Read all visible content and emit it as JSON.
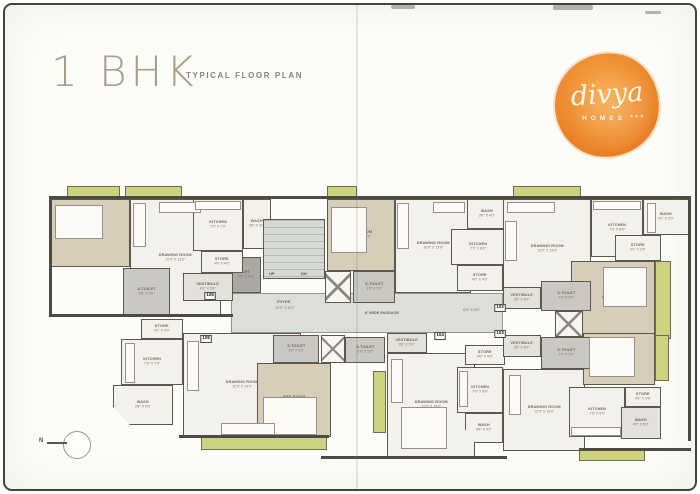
{
  "header": {
    "title": "1 BHK",
    "subtitle": "TYPICAL FLOOR PLAN"
  },
  "logo": {
    "name": "divya",
    "sub": "HOMES",
    "stars": "✶✶✶"
  },
  "compass": {
    "label": "N"
  },
  "colors": {
    "balcony_green": "#ccd27e",
    "bedroom_beige": "#d8cdb9",
    "toilet_gray": "#c9c8c2",
    "room_white": "#f3f1eb",
    "corridor_gray": "#dcded8",
    "lift_gray": "#a9a8a2",
    "wall_dark": "#4c4a42",
    "logo_orange": "#ef8f33",
    "title_taupe": "#a89e8a"
  },
  "plan": {
    "rooms": [
      {
        "f": "balc",
        "x": 62,
        "y": 181,
        "w": 53,
        "h": 13
      },
      {
        "f": "balc",
        "x": 120,
        "y": 181,
        "w": 57,
        "h": 13
      },
      {
        "f": "balc",
        "x": 322,
        "y": 181,
        "w": 30,
        "h": 13
      },
      {
        "f": "balc",
        "x": 508,
        "y": 181,
        "w": 68,
        "h": 11
      },
      {
        "f": "balc",
        "x": 650,
        "y": 256,
        "w": 16,
        "h": 78
      },
      {
        "f": "balc",
        "x": 196,
        "y": 432,
        "w": 126,
        "h": 13
      },
      {
        "f": "balc",
        "x": 368,
        "y": 366,
        "w": 13,
        "h": 62
      },
      {
        "f": "balc",
        "x": 650,
        "y": 330,
        "w": 14,
        "h": 46
      },
      {
        "f": "balc",
        "x": 574,
        "y": 444,
        "w": 66,
        "h": 12
      },
      {
        "n": "BED ROOM",
        "d": "10'0\" X 12'0\"",
        "f": "bed",
        "x": 45,
        "y": 194,
        "w": 80,
        "h": 68
      },
      {
        "n": "DRAWING ROOM",
        "d": "10'0\" X 13'0\"",
        "f": "wht",
        "x": 125,
        "y": 194,
        "w": 91,
        "h": 117
      },
      {
        "n": "KITCHEN",
        "d": "7'0\" X 7'0\"",
        "f": "wht",
        "x": 188,
        "y": 194,
        "w": 50,
        "h": 52
      },
      {
        "n": "WASH",
        "d": "3'6\" X 4'0\"",
        "f": "wht",
        "x": 238,
        "y": 194,
        "w": 28,
        "h": 50
      },
      {
        "n": "BED ROOM",
        "d": "10'0\" X 12'0\"",
        "f": "bed",
        "x": 322,
        "y": 194,
        "w": 68,
        "h": 72
      },
      {
        "n": "DRAWING ROOM",
        "d": "10'0\" X 13'0\"",
        "f": "wht",
        "x": 390,
        "y": 194,
        "w": 76,
        "h": 94
      },
      {
        "n": "WASH",
        "d": "3'6\" X 4'0\"",
        "f": "wht",
        "x": 462,
        "y": 194,
        "w": 40,
        "h": 30
      },
      {
        "n": "KITCHEN",
        "d": "7'0\" X 8'0\"",
        "f": "wht",
        "x": 446,
        "y": 224,
        "w": 54,
        "h": 36
      },
      {
        "n": "STORE",
        "d": "4'0\" X 4'0\"",
        "f": "wht",
        "x": 452,
        "y": 260,
        "w": 46,
        "h": 26
      },
      {
        "n": "DRAWING ROOM",
        "d": "11'0\" X 13'0\"",
        "f": "wht",
        "x": 498,
        "y": 194,
        "w": 88,
        "h": 100
      },
      {
        "n": "KITCHEN",
        "d": "7'0\" X 8'0\"",
        "f": "wht",
        "x": 586,
        "y": 194,
        "w": 52,
        "h": 58
      },
      {
        "n": "WASH",
        "d": "4'0\" X 5'0\"",
        "f": "wht",
        "x": 638,
        "y": 194,
        "w": 46,
        "h": 36
      },
      {
        "n": "STORE",
        "d": "4'0\" X 3'6\"",
        "f": "wht",
        "x": 610,
        "y": 230,
        "w": 46,
        "h": 26
      },
      {
        "n": "BED ROOM",
        "d": "11'0\" X 10'0\"",
        "f": "bed",
        "x": 566,
        "y": 256,
        "w": 84,
        "h": 78
      },
      {
        "n": "DRAWING ROOM",
        "d": "10'0\" X 14'0\"",
        "f": "wht",
        "x": 178,
        "y": 328,
        "w": 118,
        "h": 104
      },
      {
        "n": "STORE",
        "d": "4'0\" X 4'0\"",
        "f": "wht",
        "x": 136,
        "y": 314,
        "w": 42,
        "h": 20
      },
      {
        "n": "KITCHEN",
        "d": "7'0\" X 7'0\"",
        "f": "wht",
        "x": 116,
        "y": 334,
        "w": 62,
        "h": 46
      },
      {
        "n": "WASH",
        "d": "3'6\" X 5'0\"",
        "f": "wht",
        "ang": true,
        "x": 108,
        "y": 380,
        "w": 60,
        "h": 40
      },
      {
        "n": "BED ROOM",
        "d": "10'0\" X 10'0\"",
        "f": "bed",
        "x": 252,
        "y": 358,
        "w": 74,
        "h": 74
      },
      {
        "n": "DRAWING ROOM",
        "d": "12'0\" X 15'0\"",
        "f": "wht",
        "x": 382,
        "y": 348,
        "w": 88,
        "h": 104
      },
      {
        "n": "STORE",
        "d": "4'0\" X 4'0\"",
        "f": "wht",
        "x": 460,
        "y": 340,
        "w": 40,
        "h": 20
      },
      {
        "n": "KITCHEN",
        "d": "7'0\" X 8'0\"",
        "f": "wht",
        "x": 452,
        "y": 362,
        "w": 46,
        "h": 46
      },
      {
        "n": "WASH",
        "d": "3'6\" X 4'0\"",
        "f": "wht",
        "ang": true,
        "x": 460,
        "y": 408,
        "w": 38,
        "h": 30
      },
      {
        "n": "DRAWING ROOM",
        "d": "13'0\" X 13'0\"",
        "f": "wht",
        "x": 498,
        "y": 364,
        "w": 82,
        "h": 82
      },
      {
        "n": "BED ROOM",
        "d": "11'0\" X 10'0\"",
        "f": "bed",
        "x": 578,
        "y": 328,
        "w": 72,
        "h": 52
      },
      {
        "n": "KITCHEN",
        "d": "7'0\" X 8'0\"",
        "f": "wht",
        "x": 564,
        "y": 382,
        "w": 56,
        "h": 50
      },
      {
        "n": "STORE",
        "d": "4'0\" X 3'6\"",
        "f": "wht",
        "x": 620,
        "y": 382,
        "w": 36,
        "h": 20
      },
      {
        "n": "WASH",
        "d": "4'0\" X 5'0\"",
        "f": "ltg",
        "x": 616,
        "y": 402,
        "w": 40,
        "h": 32
      },
      {
        "f": "cor",
        "x": 226,
        "y": 288,
        "w": 272,
        "h": 40
      },
      {
        "f": "stair",
        "x": 258,
        "y": 214,
        "w": 62,
        "h": 60
      },
      {
        "n": "LIFT",
        "d": "6'0\" X 5'0\"",
        "f": "drk",
        "x": 226,
        "y": 252,
        "w": 30,
        "h": 36
      },
      {
        "n": "A.TOILET",
        "d": "3'6\" X 5'0\"",
        "f": "gry",
        "x": 118,
        "y": 263,
        "w": 47,
        "h": 48
      },
      {
        "n": "STORE",
        "d": "4'0\" X 4'0\"",
        "f": "wht",
        "x": 196,
        "y": 246,
        "w": 42,
        "h": 22
      },
      {
        "n": "VESTIBULE",
        "d": "4'0\" X 5'0\"",
        "f": "ltg",
        "x": 178,
        "y": 268,
        "w": 50,
        "h": 28
      },
      {
        "n": "S.TOILET",
        "d": "3'6\" X 5'0\"",
        "f": "gry",
        "x": 348,
        "y": 266,
        "w": 42,
        "h": 32
      },
      {
        "f": "lx",
        "x": 320,
        "y": 266,
        "w": 26,
        "h": 32
      },
      {
        "n": "VESTIBULE",
        "d": "3'6\" X 5'0\"",
        "f": "ltg",
        "x": 498,
        "y": 282,
        "w": 38,
        "h": 22
      },
      {
        "n": "S.TOILET",
        "d": "7'0\" X 5'0\"",
        "f": "gry",
        "x": 536,
        "y": 276,
        "w": 50,
        "h": 30
      },
      {
        "f": "lx",
        "x": 550,
        "y": 306,
        "w": 28,
        "h": 26
      },
      {
        "n": "VESTIBULE",
        "d": "3'6\" X 5'0\"",
        "f": "ltg",
        "x": 498,
        "y": 330,
        "w": 38,
        "h": 22
      },
      {
        "n": "S.TOILET",
        "d": "7'0\" X 5'0\"",
        "f": "gry",
        "x": 536,
        "y": 332,
        "w": 50,
        "h": 32
      },
      {
        "n": "S.TOILET",
        "d": "3'6\" X 5'0\"",
        "f": "gry",
        "x": 268,
        "y": 330,
        "w": 46,
        "h": 28
      },
      {
        "f": "lx",
        "x": 316,
        "y": 330,
        "w": 24,
        "h": 28
      },
      {
        "n": "S.TOILET",
        "d": "3'6\" X 5'0\"",
        "f": "gry",
        "x": 340,
        "y": 332,
        "w": 40,
        "h": 26
      },
      {
        "n": "VESTIBULE",
        "d": "3'6\" X 5'0\"",
        "f": "ltg",
        "x": 382,
        "y": 328,
        "w": 40,
        "h": 20
      }
    ],
    "walls": [
      {
        "x": 44,
        "y": 191,
        "w": 642,
        "h": 3
      },
      {
        "x": 44,
        "y": 191,
        "w": 3,
        "h": 121
      },
      {
        "x": 44,
        "y": 309,
        "w": 184,
        "h": 3
      },
      {
        "x": 683,
        "y": 191,
        "w": 3,
        "h": 245
      },
      {
        "x": 316,
        "y": 451,
        "w": 186,
        "h": 3
      },
      {
        "x": 174,
        "y": 430,
        "w": 150,
        "h": 3
      },
      {
        "x": 574,
        "y": 443,
        "w": 112,
        "h": 3
      }
    ],
    "furniture": [
      {
        "x": 50,
        "y": 200,
        "w": 48,
        "h": 34
      },
      {
        "x": 326,
        "y": 202,
        "w": 36,
        "h": 46
      },
      {
        "x": 598,
        "y": 262,
        "w": 44,
        "h": 40
      },
      {
        "x": 258,
        "y": 392,
        "w": 54,
        "h": 38
      },
      {
        "x": 584,
        "y": 332,
        "w": 46,
        "h": 40
      },
      {
        "x": 396,
        "y": 402,
        "w": 46,
        "h": 42
      },
      {
        "x": 128,
        "y": 198,
        "w": 13,
        "h": 44
      },
      {
        "x": 154,
        "y": 197,
        "w": 42,
        "h": 11
      },
      {
        "x": 392,
        "y": 198,
        "w": 12,
        "h": 46
      },
      {
        "x": 428,
        "y": 197,
        "w": 32,
        "h": 11
      },
      {
        "x": 502,
        "y": 197,
        "w": 48,
        "h": 11
      },
      {
        "x": 500,
        "y": 216,
        "w": 12,
        "h": 40
      },
      {
        "x": 182,
        "y": 336,
        "w": 12,
        "h": 50
      },
      {
        "x": 216,
        "y": 418,
        "w": 54,
        "h": 12
      },
      {
        "x": 386,
        "y": 354,
        "w": 12,
        "h": 44
      },
      {
        "x": 504,
        "y": 370,
        "w": 12,
        "h": 40
      },
      {
        "x": 190,
        "y": 196,
        "w": 46,
        "h": 9
      },
      {
        "x": 588,
        "y": 196,
        "w": 48,
        "h": 9
      },
      {
        "x": 120,
        "y": 338,
        "w": 10,
        "h": 40
      },
      {
        "x": 566,
        "y": 422,
        "w": 50,
        "h": 9
      },
      {
        "x": 454,
        "y": 366,
        "w": 9,
        "h": 36
      },
      {
        "x": 642,
        "y": 198,
        "w": 9,
        "h": 30
      }
    ],
    "texts": [
      {
        "t": "UP",
        "x": 264,
        "y": 267,
        "c": "tb"
      },
      {
        "t": "DN",
        "x": 296,
        "y": 267,
        "c": "tb"
      },
      {
        "t": "FOYER",
        "x": 272,
        "y": 295,
        "c": "tn"
      },
      {
        "t": "10'0\" X 8'0\"",
        "x": 270,
        "y": 301,
        "c": "td"
      },
      {
        "t": "8' WIDE PASSAGE",
        "x": 360,
        "y": 306,
        "c": "tn"
      },
      {
        "t": "8'0\" X 8'0\"",
        "x": 458,
        "y": 303,
        "c": "td"
      }
    ],
    "units": [
      {
        "no": "106",
        "x": 198,
        "y": 286
      },
      {
        "no": "105",
        "x": 194,
        "y": 329
      },
      {
        "no": "104",
        "x": 428,
        "y": 326
      },
      {
        "no": "102",
        "x": 488,
        "y": 298
      },
      {
        "no": "103",
        "x": 488,
        "y": 324
      }
    ],
    "smudges": [
      {
        "x": 386,
        "y": 0,
        "w": 24,
        "h": 4
      },
      {
        "x": 548,
        "y": 0,
        "w": 40,
        "h": 5
      },
      {
        "x": 640,
        "y": 6,
        "w": 16,
        "h": 3
      }
    ]
  }
}
